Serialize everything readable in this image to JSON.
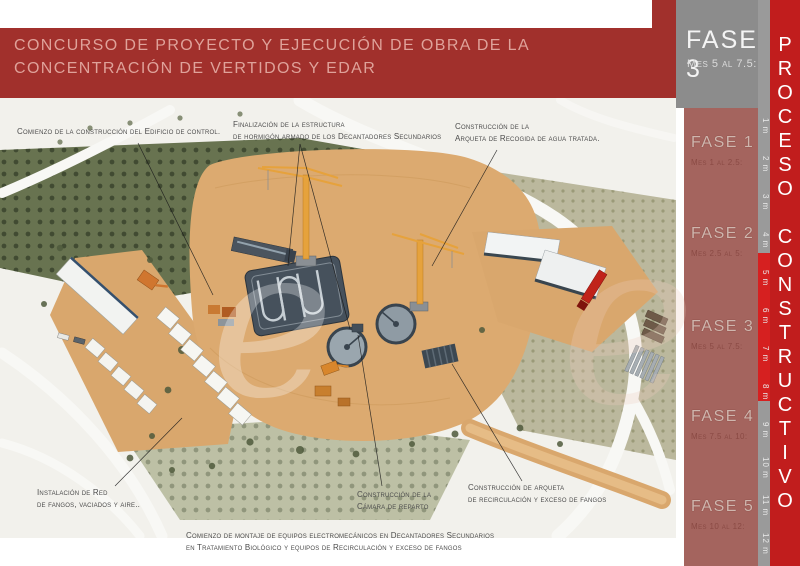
{
  "title": {
    "line1": "CONCURSO DE PROYECTO Y EJECUCIÓN DE OBRA DE LA",
    "line2": "CONCENTRACIÓN DE VERTIDOS Y EDAR"
  },
  "sidebar": {
    "current_phase": {
      "name": "FASE 3",
      "period": "Mes 5 al 7.5:"
    },
    "phases": [
      {
        "name": "FASE 1",
        "period": "Mes 1 al 2.5:"
      },
      {
        "name": "FASE 2",
        "period": "Mes 2.5 al 5:"
      },
      {
        "name": "FASE 3",
        "period": "Mes 5 al 7.5:"
      },
      {
        "name": "FASE 4",
        "period": "Mes 7.5 al 10:"
      },
      {
        "name": "FASE 5",
        "period": "Mes 10 al 12:"
      }
    ],
    "months": [
      "1 m",
      "2 m",
      "3 m",
      "4 m",
      "5 m",
      "6 m",
      "7 m",
      "8 m",
      "9 m",
      "10 m",
      "11 m",
      "12 m"
    ],
    "highlighted_months": [
      "5 m",
      "6 m",
      "7 m",
      "8 m"
    ],
    "vertical_title": "PROCESO CONSTRUCTIVO"
  },
  "annotations": [
    {
      "id": "control-building",
      "lines": [
        "Comienzo de la construcción del Edificio de control.",
        ""
      ]
    },
    {
      "id": "secondary-decanters",
      "lines": [
        "Finalización de la estructura",
        "de hormigón armado de los Decantadores Secundarios"
      ]
    },
    {
      "id": "treated-water-chamber",
      "lines": [
        "Construcción de la",
        "Arqueta de Recogida de agua tratada."
      ]
    },
    {
      "id": "sludge-network",
      "lines": [
        "Instalación de Red",
        "de fangos, vaciados y aire.."
      ]
    },
    {
      "id": "distribution-chamber",
      "lines": [
        "Construcción de la",
        "Cámara de reparto"
      ]
    },
    {
      "id": "recirculation-chamber",
      "lines": [
        "Construcción de arqueta",
        "de recirculación y exceso de fangos"
      ]
    },
    {
      "id": "bottom-note",
      "lines": [
        "Comienzo de montaje de equipos electromecánicos  en Decantadores Secundarios",
        "en Tratamiento Biológico y equipos de Recirculación y exceso de fangos"
      ]
    }
  ],
  "watermark": {
    "letter": "e"
  },
  "colors": {
    "banner": "#a1302c",
    "banner_text": "#dfa29a",
    "sidebar_gray": "#8c8c8c",
    "phase_panel": "#a4645e",
    "month_strip": "#9a9a9a",
    "highlight_red": "#d62020",
    "process_bar_red": "#c11d1d",
    "sand_pad": "#dcaa70",
    "annotation_text": "#4c4c4c"
  }
}
